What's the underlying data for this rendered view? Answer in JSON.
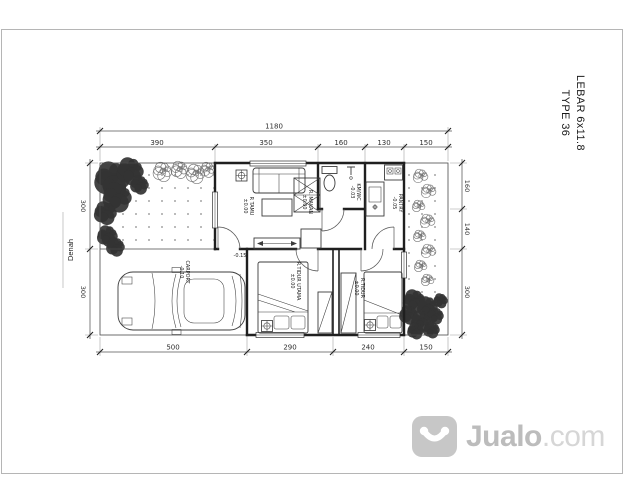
{
  "title_block": {
    "line1": "LEBAR 6x11.8",
    "line2": "TYPE 36"
  },
  "drawing_label": "Denah",
  "dimensions": {
    "top_total": "1180",
    "top_segments": [
      "390",
      "350",
      "160",
      "130",
      "150"
    ],
    "bottom_segments": [
      "500",
      "290",
      "240",
      "150"
    ],
    "left_segments": [
      "300",
      "300"
    ],
    "right_segments": [
      "160",
      "140",
      "300"
    ]
  },
  "rooms": [
    {
      "name": "R TAMU",
      "level": "±0.00"
    },
    {
      "name": "R. MAKAN",
      "level": "±0.00"
    },
    {
      "name": "KM/WC",
      "level": "-0.03"
    },
    {
      "name": "PANTRY",
      "level": "-0.05"
    },
    {
      "name": "R.TIDUR UTAMA",
      "level": "±0.00"
    },
    {
      "name": "R.TIDUR",
      "level": "±0.00"
    },
    {
      "name": "CARPORT",
      "level": "-0.10"
    }
  ],
  "annotations": {
    "entry_level": "-0.15"
  },
  "watermark": {
    "name": "Jualo",
    "tld": ".com"
  },
  "colors": {
    "plan_line": "#1f1f1f",
    "watermark_gray": "#bcbcbc",
    "frame_gray": "#b5b5b5"
  }
}
